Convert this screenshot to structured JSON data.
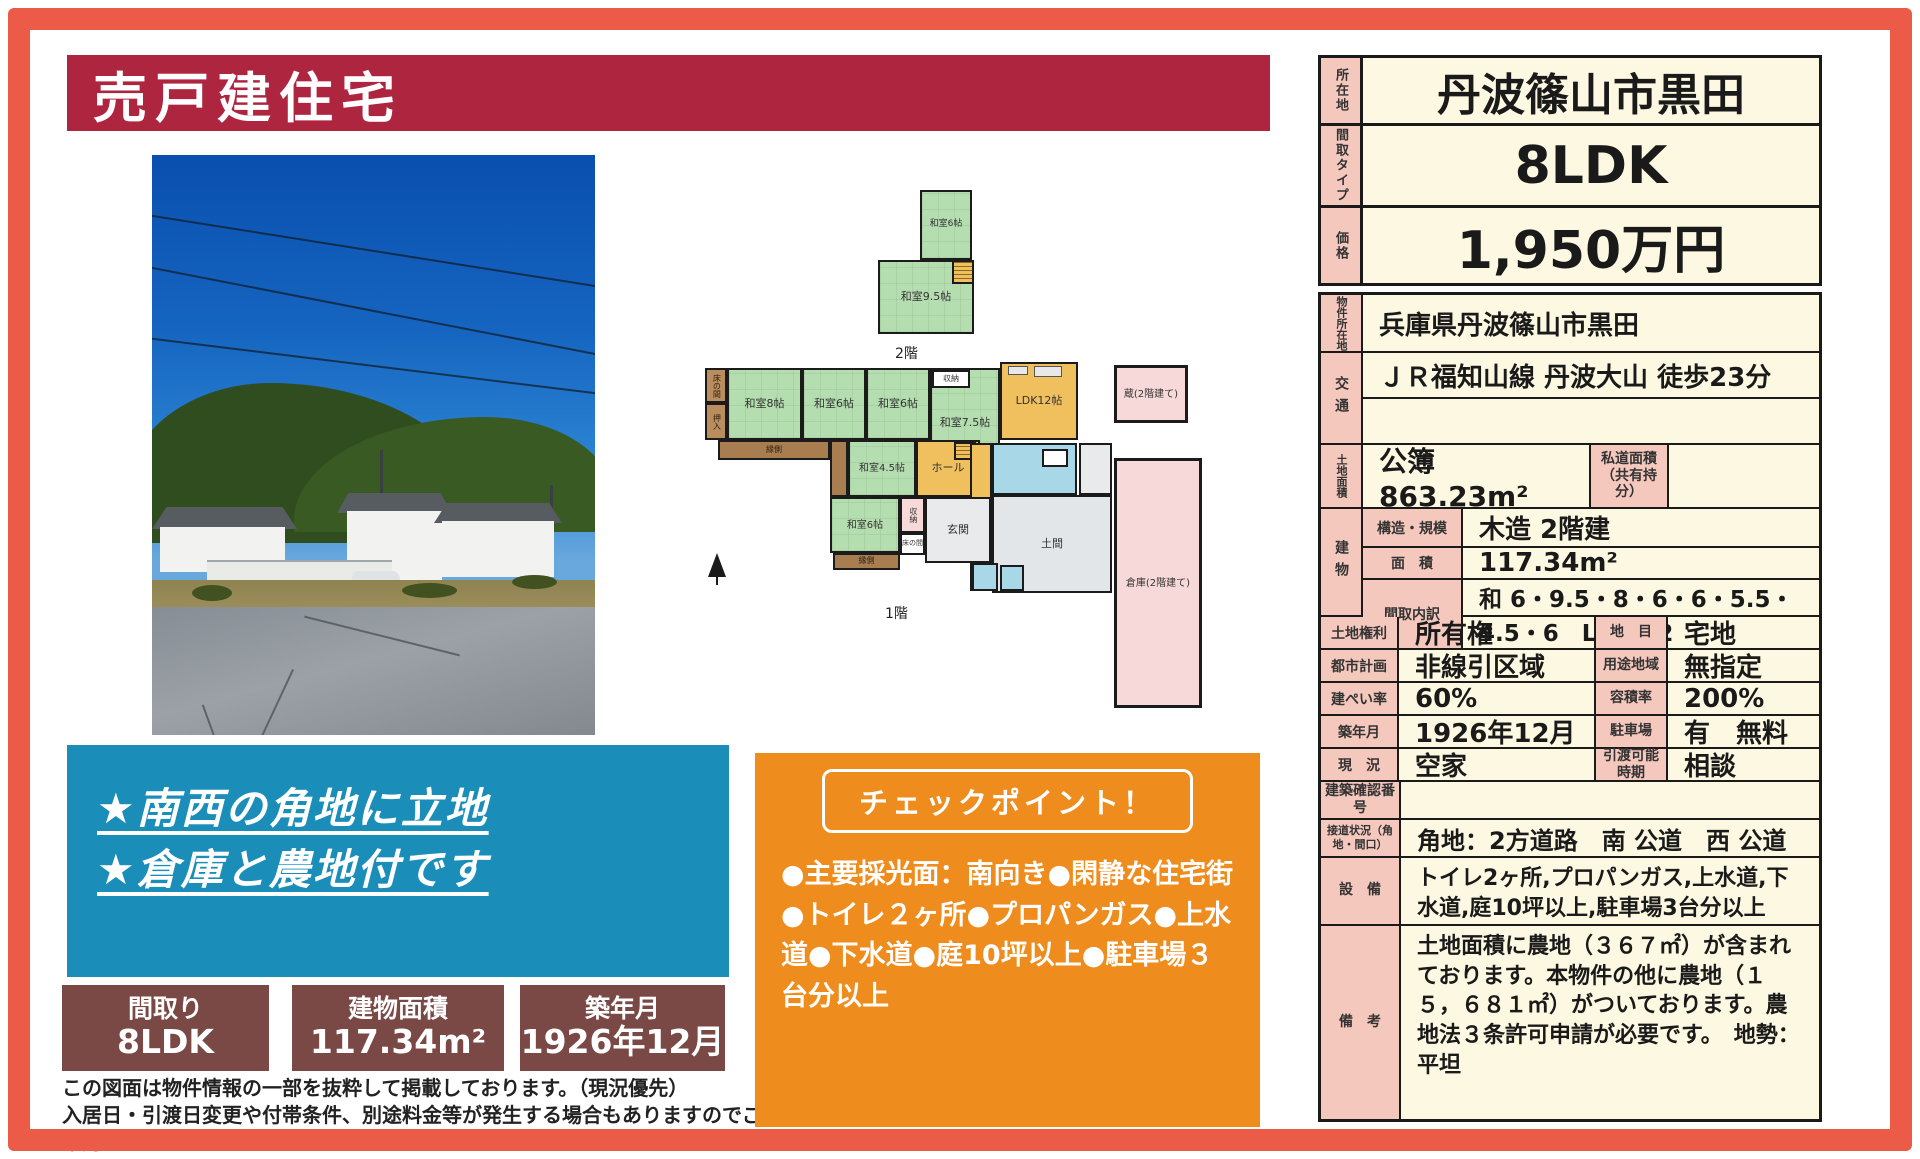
{
  "banner": {
    "title": "売戸建住宅"
  },
  "highlight": {
    "line1": "★南西の角地に立地",
    "line2": "★倉庫と農地付です"
  },
  "spec_boxes": [
    {
      "label": "間取り",
      "value": "8LDK"
    },
    {
      "label": "建物面積",
      "value": "117.34m²"
    },
    {
      "label": "築年月",
      "value": "1926年12月"
    }
  ],
  "disclaimer": {
    "line1": "この図面は物件情報の一部を抜粋して掲載しております。（現況優先）",
    "line2": "入居日・引渡日変更や付帯条件、別途料金等が発生する場合もありますのでご確認ください。"
  },
  "checkpoint": {
    "title": "チェックポイント！",
    "body": "●主要採光面：南向き●閑静な住宅街●トイレ２ヶ所●プロパンガス●上水道●下水道●庭10坪以上●駐車場３台分以上"
  },
  "summary": {
    "rows": [
      {
        "label": "所在地",
        "value": "丹波篠山市黒田"
      },
      {
        "label": "間取タイプ",
        "value": "8LDK"
      },
      {
        "label": "価格",
        "value": "1,950万円"
      }
    ]
  },
  "details": {
    "bukken": {
      "label": "物件所在地",
      "value": "兵庫県丹波篠山市黒田"
    },
    "kotsu": {
      "label": "交通",
      "value": "ＪＲ福知山線 丹波大山 徒歩23分",
      "value2": ""
    },
    "tochi": {
      "label": "土地面積",
      "value": "公簿 863.23m²",
      "sub_label": "私道面積（共有持分）",
      "sub_value": ""
    },
    "tatemono": {
      "label": "建物",
      "rows": [
        {
          "label": "構造・規模",
          "value": "木造 2階建"
        },
        {
          "label": "面　積",
          "value": "117.34m²"
        },
        {
          "label": "間取内訳",
          "value": "和 6・9.5・8・6・6・5.5・4.5・6　LDK 12"
        }
      ]
    },
    "pairs": [
      {
        "l1": "土地権利",
        "v1": "所有権",
        "l2": "地　目",
        "v2": "宅地"
      },
      {
        "l1": "都市計画",
        "v1": "非線引区域",
        "l2": "用途地域",
        "v2": "無指定"
      },
      {
        "l1": "建ぺい率",
        "v1": "60%",
        "l2": "容積率",
        "v2": "200%"
      },
      {
        "l1": "築年月",
        "v1": "1926年12月",
        "l2": "駐車場",
        "v2": "有　無料"
      },
      {
        "l1": "現　況",
        "v1": "空家",
        "l2": "引渡可能時期",
        "v2": "相談"
      }
    ],
    "kakunin": {
      "label": "建築確認番号",
      "value": ""
    },
    "setsudo": {
      "label": "接道状況（角地・間口）",
      "value": "角地：2方道路　南 公道　西 公道"
    },
    "setsubi": {
      "label": "設　備",
      "value": "トイレ2ヶ所,プロパンガス,上水道,下水道,庭10坪以上,駐車場3台分以上"
    },
    "biko": {
      "label": "備　考",
      "value": "土地面積に農地（３６７㎡）が含まれております。本物件の他に農地（１５，６８１㎡）がついております。農地法３条許可申請が必要です。　地勢：平坦"
    }
  },
  "floorplan": {
    "floor2_label": "2階",
    "floor1_label": "1階",
    "rooms": [
      {
        "label": "和室6帖"
      },
      {
        "label": "和室9.5帖"
      },
      {
        "label": "床の間"
      },
      {
        "label": "押入"
      },
      {
        "label": "和室8帖"
      },
      {
        "label": "和室6帖"
      },
      {
        "label": "和室6帖"
      },
      {
        "label": "収納"
      },
      {
        "label": "和室7.5帖"
      },
      {
        "label": "LDK12帖"
      },
      {
        "label": "蔵(2階建て)"
      },
      {
        "label": "縁側"
      },
      {
        "label": "和室4.5帖"
      },
      {
        "label": "ホール"
      },
      {
        "label": "和室6帖"
      },
      {
        "label": "収納"
      },
      {
        "label": "床の間"
      },
      {
        "label": "玄関"
      },
      {
        "label": "土間"
      },
      {
        "label": "縁側"
      },
      {
        "label": "倉庫(2階建て)"
      }
    ]
  },
  "colors": {
    "frame": "#ec5a48",
    "banner": "#ae2540",
    "highlight_blue": "#1a8db8",
    "spec_brown": "#7a4946",
    "checkpoint_orange": "#ef8c1e",
    "label_pink": "#f5c8be",
    "value_cream": "#fdf8e1"
  }
}
